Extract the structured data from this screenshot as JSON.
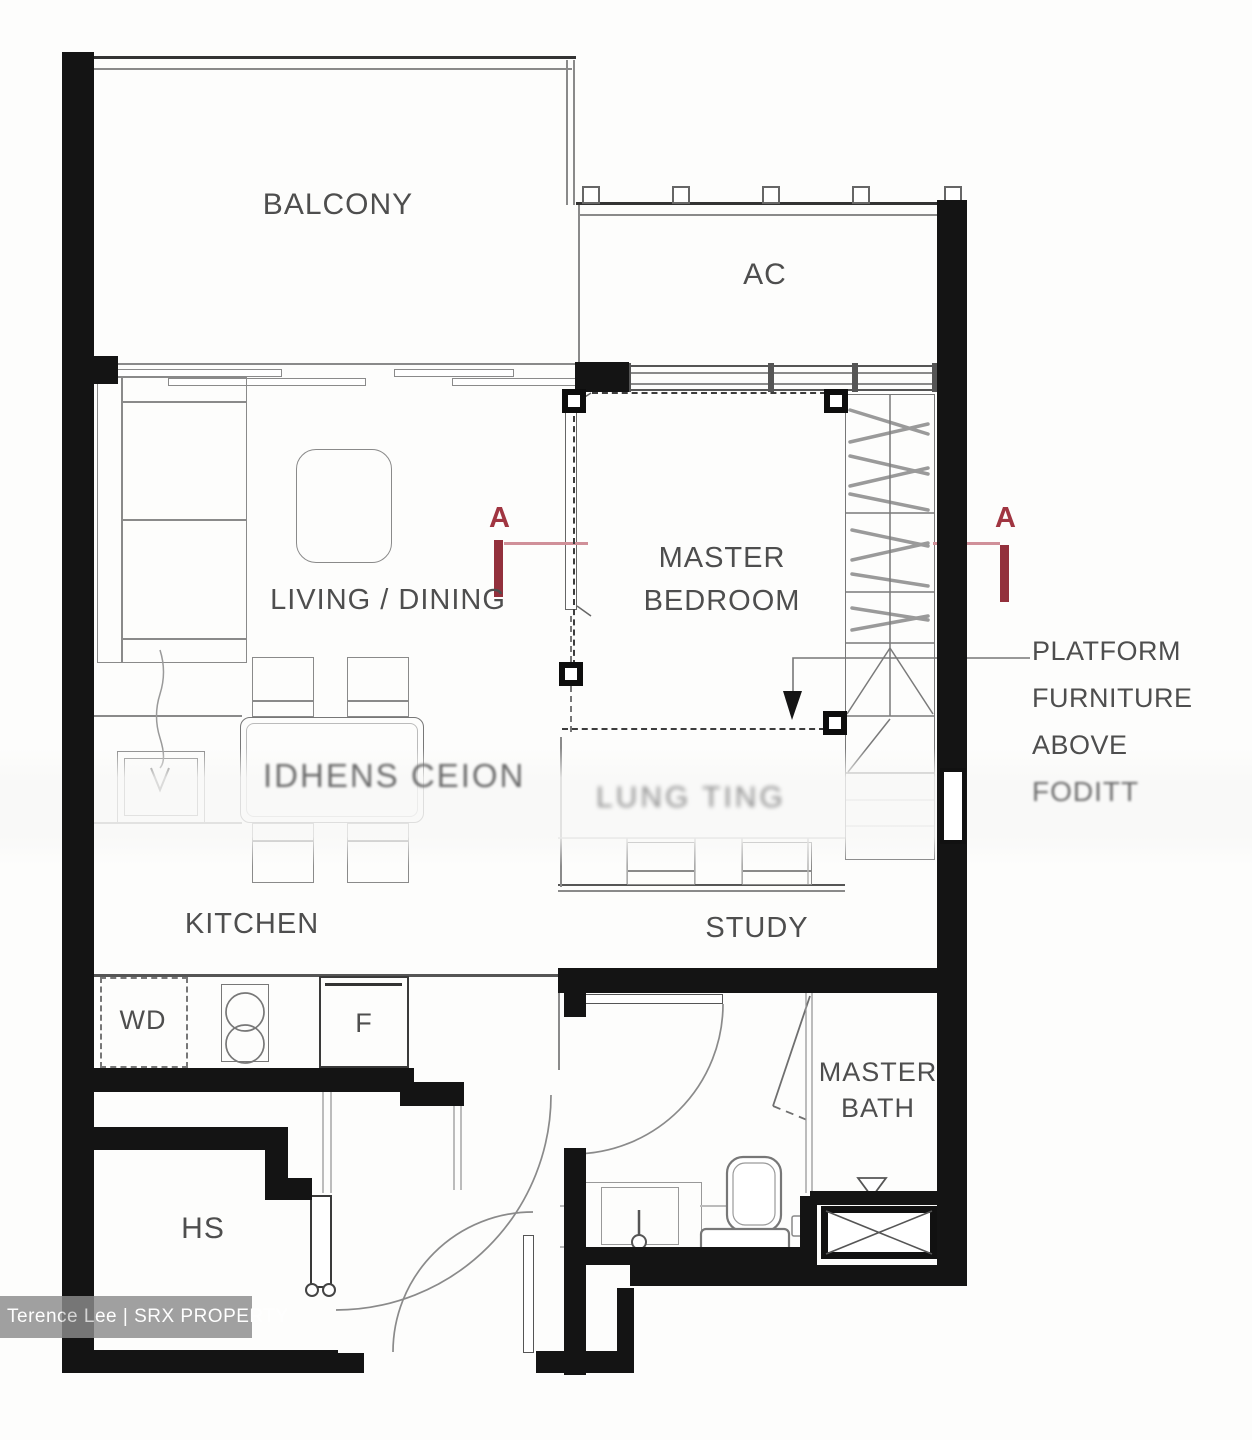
{
  "plan": {
    "rooms": {
      "balcony": "BALCONY",
      "ac": "AC",
      "living_dining": "LIVING / DINING",
      "master_bedroom_line1": "MASTER",
      "master_bedroom_line2": "BEDROOM",
      "kitchen": "KITCHEN",
      "study": "STUDY",
      "master_bath_line1": "MASTER",
      "master_bath_line2": "BATH",
      "household_shelter": "HS"
    },
    "appliances": {
      "washer_dryer": "WD",
      "fridge": "F"
    },
    "annotations": {
      "section_marker_left": "A",
      "section_marker_right": "A",
      "platform_line1": "PLATFORM",
      "platform_line2": "FURNITURE",
      "platform_line3": "ABOVE",
      "platform_line4_faint": "FODITT",
      "blurred_text_dining": "IDHENS CEION",
      "blurred_text_study": "LUNG TING"
    }
  },
  "watermark": {
    "text": "Terence Lee | SRX PROPERTY"
  },
  "colors": {
    "wall": "#141414",
    "thin_line": "#8a8a8a",
    "label_text": "#4e4e4e",
    "section_red": "#a03541",
    "section_red_bar": "#93303c",
    "section_red_line": "#d09099",
    "watermark_bg": "#8c8c8c",
    "watermark_text": "#ffffff"
  }
}
